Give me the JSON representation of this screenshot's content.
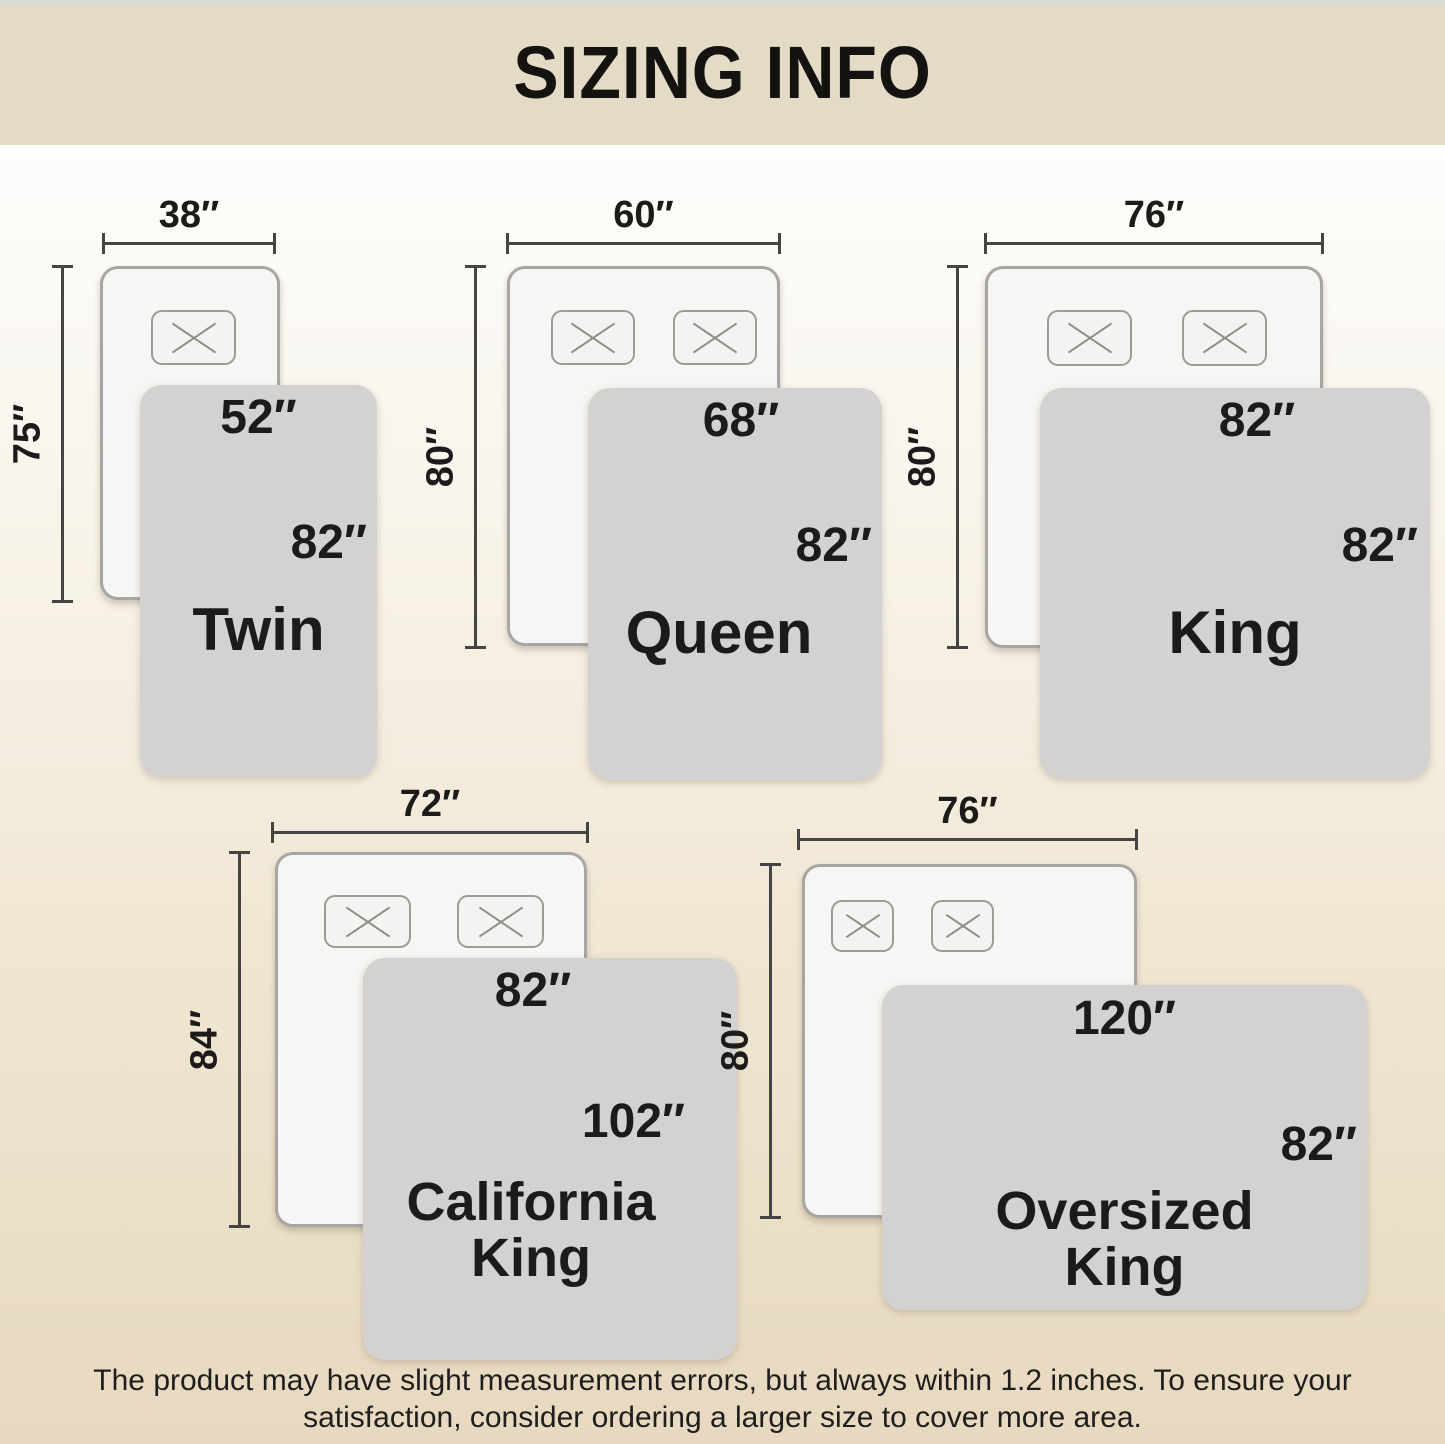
{
  "title": "SIZING INFO",
  "colors": {
    "banner_bg": "#e4dbc7",
    "bg_top": "#fdfdfc",
    "bg_bottom": "#e7d9bf",
    "blanket_fill": "#d3d2d0",
    "bed_fill": "#f7f6f4",
    "bed_border": "#a8a6a3",
    "pillow_border": "#9d9b98",
    "dim_color": "#454442",
    "ink": "#1c1b19"
  },
  "sizes": [
    {
      "name": "Twin",
      "bed_width": "38″",
      "bed_length": "75″",
      "blanket_width": "52″",
      "blanket_length": "82″",
      "pillow_count": 1
    },
    {
      "name": "Queen",
      "bed_width": "60″",
      "bed_length": "80″",
      "blanket_width": "68″",
      "blanket_length": "82″",
      "pillow_count": 2
    },
    {
      "name": "King",
      "bed_width": "76″",
      "bed_length": "80″",
      "blanket_width": "82″",
      "blanket_length": "82″",
      "pillow_count": 2
    },
    {
      "name": "California King",
      "bed_width": "72″",
      "bed_length": "84″",
      "blanket_width": "82″",
      "blanket_length": "102″",
      "pillow_count": 2
    },
    {
      "name": "Oversized King",
      "bed_width": "76″",
      "bed_length": "80″",
      "blanket_width": "120″",
      "blanket_length": "82″",
      "pillow_count": 2
    }
  ],
  "footer": {
    "line1": "The product may have slight measurement errors, but always within 1.2 inches. To ensure your",
    "line2": "satisfaction, consider ordering a larger size to cover more area."
  }
}
